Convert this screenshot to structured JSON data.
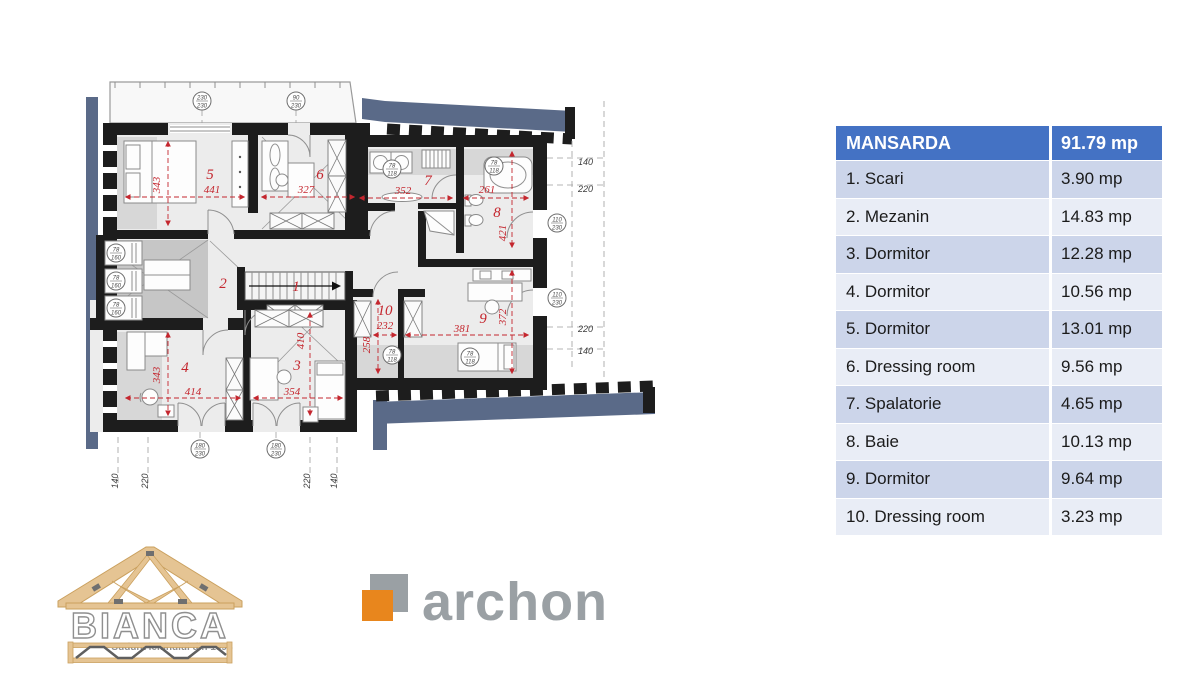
{
  "floorplan": {
    "title": "Mansarda floor plan",
    "rooms": [
      {
        "number": "1",
        "name": "Scari",
        "dims": []
      },
      {
        "number": "2",
        "name": "Mezanin",
        "dims": []
      },
      {
        "number": "3",
        "name": "Dormitor",
        "dims": [
          "354",
          "410"
        ]
      },
      {
        "number": "4",
        "name": "Dormitor",
        "dims": [
          "414",
          "343"
        ]
      },
      {
        "number": "5",
        "name": "Dormitor",
        "dims": [
          "441",
          "343"
        ]
      },
      {
        "number": "6",
        "name": "Dressing room",
        "dims": [
          "327"
        ]
      },
      {
        "number": "7",
        "name": "Spalatorie",
        "dims": [
          "352"
        ]
      },
      {
        "number": "8",
        "name": "Baie",
        "dims": [
          "261",
          "421"
        ]
      },
      {
        "number": "9",
        "name": "Dormitor",
        "dims": [
          "381",
          "372"
        ]
      },
      {
        "number": "10",
        "name": "Dressing room",
        "dims": [
          "232",
          "258"
        ]
      }
    ],
    "windows": [
      {
        "t": "230",
        "b": "230"
      },
      {
        "t": "90",
        "b": "230"
      },
      {
        "t": "78",
        "b": "160"
      },
      {
        "t": "78",
        "b": "160"
      },
      {
        "t": "78",
        "b": "160"
      },
      {
        "t": "78",
        "b": "118"
      },
      {
        "t": "78",
        "b": "118"
      },
      {
        "t": "110",
        "b": "230"
      },
      {
        "t": "110",
        "b": "230"
      },
      {
        "t": "78",
        "b": "118"
      },
      {
        "t": "78",
        "b": "118"
      },
      {
        "t": "180",
        "b": "230"
      },
      {
        "t": "180",
        "b": "230"
      }
    ],
    "edge_dims_right": [
      "140",
      "220",
      "220",
      "140"
    ],
    "edge_dims_bottom": [
      "140",
      "220",
      "220",
      "140"
    ]
  },
  "table": {
    "header": {
      "name": "MANSARDA",
      "area": "91.79 mp"
    },
    "rows": [
      {
        "name": "1. Scari",
        "area": "3.90 mp"
      },
      {
        "name": "2. Mezanin",
        "area": "14.83 mp"
      },
      {
        "name": "3. Dormitor",
        "area": "12.28 mp"
      },
      {
        "name": "4. Dormitor",
        "area": "10.56 mp"
      },
      {
        "name": "5. Dormitor",
        "area": "13.01 mp"
      },
      {
        "name": "6. Dressing room",
        "area": "9.56 mp"
      },
      {
        "name": "7. Spalatorie",
        "area": "4.65 mp"
      },
      {
        "name": "8. Baie",
        "area": "10.13 mp"
      },
      {
        "name": "9. Dormitor",
        "area": "9.64 mp"
      },
      {
        "name": "10. Dressing room",
        "area": "3.23 mp"
      }
    ]
  },
  "logos": {
    "bianca": {
      "name": "BIANCA",
      "tagline": "Sudura lemnului din 1994"
    },
    "archon": {
      "name": "archon"
    }
  },
  "colors": {
    "table_header_bg": "#4472c4",
    "table_row_odd": "#ccd5ea",
    "table_row_even": "#e9edf6",
    "roof_band": "#5a6a88",
    "dimension_red": "#c4262e",
    "archon_orange": "#e8861d",
    "logo_gray": "#9aa0a4",
    "wood_tan": "#e5c493"
  }
}
